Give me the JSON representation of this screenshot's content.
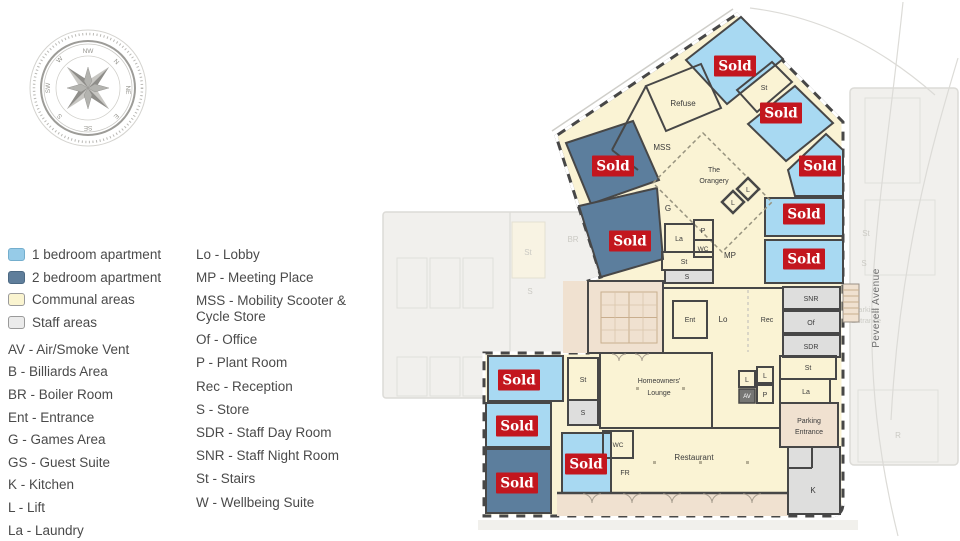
{
  "legend": {
    "items": [
      {
        "label": "1 bedroom apartment",
        "color": "#96cbe8"
      },
      {
        "label": "2 bedroom apartment",
        "color": "#5f7e9b"
      },
      {
        "label": "Communal areas",
        "color": "#faf4d0"
      },
      {
        "label": "Staff areas",
        "color": "#ebebeb"
      }
    ],
    "abbr_left": [
      "AV - Air/Smoke Vent",
      "B - Billiards Area",
      "BR - Boiler Room",
      "Ent - Entrance",
      "G - Games Area",
      "GS - Guest Suite",
      "K - Kitchen",
      "L - Lift",
      "La - Laundry"
    ],
    "abbr_right": [
      "Lo - Lobby",
      "MP - Meeting Place",
      "MSS - Mobility Scooter & Cycle Store",
      "Of - Office",
      "P - Plant Room",
      "Rec - Reception",
      "S - Store",
      "SDR - Staff Day Room",
      "SNR - Staff Night Room",
      "St - Stairs",
      "W - Wellbeing Suite"
    ]
  },
  "compass": {
    "labels": {
      "n": "N",
      "ne": "NE",
      "e": "E",
      "se": "SE",
      "s": "S",
      "sw": "SW",
      "w": "W",
      "nw": "NW"
    }
  },
  "plan": {
    "sold": {
      "label": "Sold",
      "color": "#c3161e",
      "count": 11
    },
    "street": "Peverell Avenue",
    "labels": {
      "refuse": "Refuse",
      "mss": "MSS",
      "orangery_1": "The",
      "orangery_2": "Orangery",
      "g": "G",
      "mp": "MP",
      "st": "St",
      "s": "S",
      "l": "L",
      "la": "La",
      "p": "P",
      "wc": "WC",
      "av": "AV",
      "ent": "Ent",
      "lo": "Lo",
      "rec": "Rec",
      "snr": "SNR",
      "of": "Of",
      "sdr": "SDR",
      "lounge_1": "Homeowners'",
      "lounge_2": "Lounge",
      "restaurant": "Restaurant",
      "fr": "FR",
      "k": "K",
      "parking_1": "Parking",
      "parking_2": "Entrance"
    },
    "background_labels": {
      "st": "St",
      "s": "S",
      "br": "BR",
      "r": "R",
      "parking_1": "Parking",
      "parking_2": "Entrance"
    },
    "colors": {
      "one_bed": "#a8d9f2",
      "two_bed": "#5c7e9d",
      "communal": "#faf3d4",
      "staff": "#dededd",
      "terrace": "#f0e1d0",
      "wall": "#474747"
    }
  }
}
